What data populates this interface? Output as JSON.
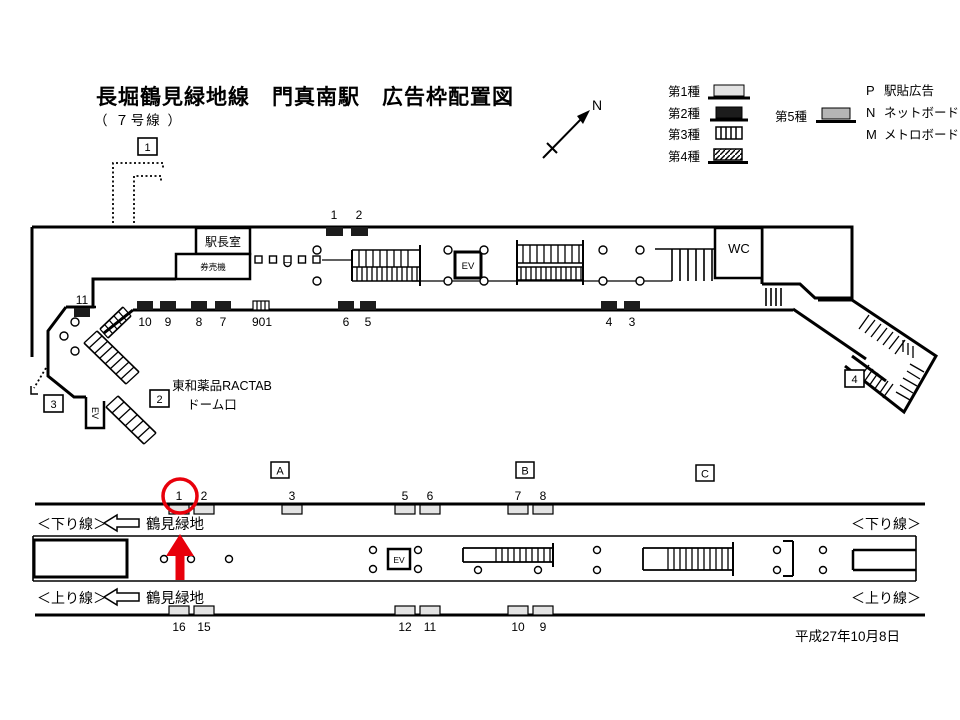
{
  "title": "長堀鶴見緑地線　門真南駅　広告枠配置図",
  "subtitle": "（ ７号線 ）",
  "compass_label": "N",
  "date": "平成27年10月8日",
  "legend": {
    "type1": "第1種",
    "type2": "第2種",
    "type3": "第3種",
    "type4": "第4種",
    "type5": "第5種",
    "p_code": "P",
    "p_label": "駅貼広告",
    "n_code": "N",
    "n_label": "ネットボード",
    "m_code": "M",
    "m_label": "メトロボード"
  },
  "concourse": {
    "station_master_room": "駅長室",
    "ticket_machines": "券売機",
    "toilet": "WC",
    "elevator": "EV",
    "exit_elevator": "EV",
    "facility_line1": "東和薬品RACTAB",
    "facility_line2": "ドーム口",
    "exits": {
      "e1": "1",
      "e2": "2",
      "e3": "3",
      "e4": "4"
    },
    "top_ads": {
      "a1": "1",
      "a2": "2"
    },
    "bottom_ads": {
      "b11": "11",
      "b10": "10",
      "b9": "9",
      "b8": "8",
      "b7": "7",
      "b901": "901",
      "b6": "6",
      "b5": "5",
      "b4": "4",
      "b3": "3"
    }
  },
  "platform": {
    "sections": {
      "a": "A",
      "b": "B",
      "c": "C"
    },
    "elevator": "EV",
    "down_line": "＜下り線＞",
    "up_line": "＜上り線＞",
    "direction": "鶴見緑地",
    "top_ads": {
      "n1": "1",
      "n2": "2",
      "n3": "3",
      "n5": "5",
      "n6": "6",
      "n7": "7",
      "n8": "8"
    },
    "bottom_ads": {
      "n16": "16",
      "n15": "15",
      "n12": "12",
      "n11": "11",
      "n10": "10",
      "n9": "9"
    }
  },
  "colors": {
    "red": "#e8000b",
    "type1_fill": "#e3e3e3",
    "type2_fill": "#1c1c1c",
    "type5_fill": "#b5b5b5"
  }
}
